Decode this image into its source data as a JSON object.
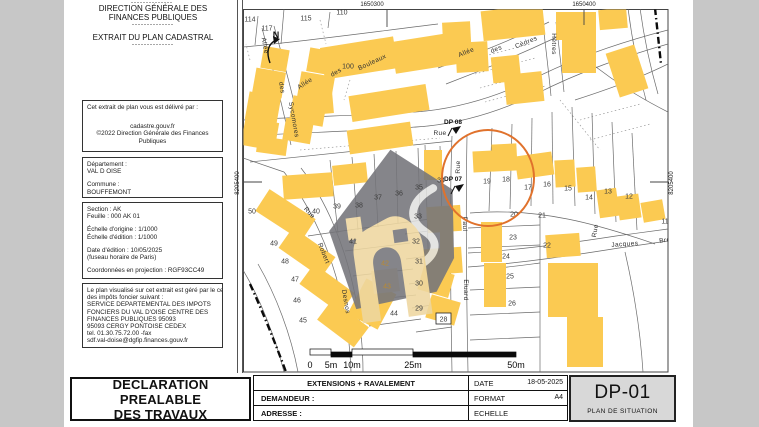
{
  "left_panel": {
    "top_dashes": "--------------",
    "header": {
      "line1": "DIRECTION GÉNÉRALE DES",
      "line2": "FINANCES PUBLIQUES",
      "dash1": "--------------",
      "subtitle": "EXTRAIT DU PLAN CADASTRAL",
      "dash2": "--------------"
    },
    "issuer_box": {
      "intro": "Cet extrait de plan vous est délivré par :",
      "site": "cadastre.gouv.fr",
      "copyright": "©2022 Direction Générale des Finances Publiques"
    },
    "location_box": {
      "lines": [
        "Département :",
        "VAL D OISE",
        "",
        "Commune :",
        "BOUFFEMONT"
      ]
    },
    "sheet_box": {
      "lines": [
        "Section : AK",
        "Feuille : 000 AK 01",
        "",
        "Échelle d'origine : 1/1000",
        "Échelle d'édition : 1/1000",
        "",
        "Date d'édition : 10/05/2025",
        "(fuseau horaire de Paris)",
        "",
        "Coordonnées en projection : RGF93CC49"
      ]
    },
    "office_box": {
      "lines": [
        "Le plan visualisé sur cet extrait est géré par le centre",
        "des impôts foncier suivant :",
        "SERVICE DEPARTEMENTAL DES IMPOTS",
        "FONCIERS DU VAL D'OISE CENTRE DES",
        "FINANCES PUBLIQUES 95093",
        "95093 CERGY PONTOISE CEDEX",
        "tel. 01.30.75.72.00 -fax",
        "sdf.val-doise@dgfip.finances.gouv.fr"
      ]
    }
  },
  "map": {
    "coords": [
      {
        "t": "1650300",
        "x": 372,
        "y": 6,
        "r": 0
      },
      {
        "t": "1650400",
        "x": 584,
        "y": 6,
        "r": 0
      },
      {
        "t": "8205400",
        "x": 239,
        "y": 183,
        "r": -90
      },
      {
        "t": "8205400",
        "x": 673,
        "y": 183,
        "r": -90
      }
    ],
    "north_label": "N",
    "parcels": [
      {
        "n": "114",
        "x": 250,
        "y": 19
      },
      {
        "n": "117",
        "x": 267,
        "y": 28
      },
      {
        "n": "115",
        "x": 306,
        "y": 18
      },
      {
        "n": "110",
        "x": 342,
        "y": 12
      },
      {
        "n": "100",
        "x": 348,
        "y": 66
      },
      {
        "n": "50",
        "x": 252,
        "y": 211
      },
      {
        "n": "49",
        "x": 274,
        "y": 243
      },
      {
        "n": "48",
        "x": 285,
        "y": 261
      },
      {
        "n": "47",
        "x": 295,
        "y": 279
      },
      {
        "n": "46",
        "x": 297,
        "y": 300
      },
      {
        "n": "45",
        "x": 303,
        "y": 320
      },
      {
        "n": "40",
        "x": 316,
        "y": 211
      },
      {
        "n": "39",
        "x": 337,
        "y": 206
      },
      {
        "n": "38",
        "x": 359,
        "y": 205
      },
      {
        "n": "37",
        "x": 378,
        "y": 197
      },
      {
        "n": "36",
        "x": 399,
        "y": 193
      },
      {
        "n": "35",
        "x": 419,
        "y": 187
      },
      {
        "n": "34",
        "x": 441,
        "y": 180
      },
      {
        "n": "41",
        "x": 353,
        "y": 241
      },
      {
        "n": "42",
        "x": 385,
        "y": 263,
        "hl": true
      },
      {
        "n": "43",
        "x": 387,
        "y": 286,
        "hl": true
      },
      {
        "n": "44",
        "x": 394,
        "y": 313
      },
      {
        "n": "33",
        "x": 418,
        "y": 216
      },
      {
        "n": "32",
        "x": 416,
        "y": 241
      },
      {
        "n": "31",
        "x": 419,
        "y": 261
      },
      {
        "n": "30",
        "x": 419,
        "y": 283
      },
      {
        "n": "29",
        "x": 419,
        "y": 308
      },
      {
        "n": "19",
        "x": 487,
        "y": 181
      },
      {
        "n": "18",
        "x": 506,
        "y": 179
      },
      {
        "n": "17",
        "x": 528,
        "y": 187
      },
      {
        "n": "16",
        "x": 547,
        "y": 184
      },
      {
        "n": "15",
        "x": 568,
        "y": 188
      },
      {
        "n": "14",
        "x": 589,
        "y": 197
      },
      {
        "n": "13",
        "x": 608,
        "y": 191
      },
      {
        "n": "12",
        "x": 629,
        "y": 196
      },
      {
        "n": "11",
        "x": 665,
        "y": 221
      },
      {
        "n": "20",
        "x": 514,
        "y": 214
      },
      {
        "n": "21",
        "x": 542,
        "y": 215
      },
      {
        "n": "22",
        "x": 547,
        "y": 245
      },
      {
        "n": "23",
        "x": 513,
        "y": 237
      },
      {
        "n": "24",
        "x": 506,
        "y": 256
      },
      {
        "n": "25",
        "x": 510,
        "y": 276
      },
      {
        "n": "26",
        "x": 512,
        "y": 303
      }
    ],
    "boxed_parcel": {
      "n": "28",
      "x": 436,
      "y": 313,
      "w": 15,
      "h": 11
    },
    "streets": [
      {
        "t": "Allée",
        "x": 263,
        "y": 46,
        "r": 80
      },
      {
        "t": "des",
        "x": 280,
        "y": 88,
        "r": 80
      },
      {
        "t": "Sycomores",
        "x": 292,
        "y": 120,
        "r": 80
      },
      {
        "t": "Allée",
        "x": 306,
        "y": 85,
        "r": -33
      },
      {
        "t": "des",
        "x": 337,
        "y": 74,
        "r": -30
      },
      {
        "t": "Bouleaux",
        "x": 373,
        "y": 64,
        "r": -25
      },
      {
        "t": "Allée",
        "x": 467,
        "y": 54,
        "r": -22
      },
      {
        "t": "des",
        "x": 497,
        "y": 51,
        "r": -22
      },
      {
        "t": "Cèdres",
        "x": 527,
        "y": 44,
        "r": -22
      },
      {
        "t": "Hêtres",
        "x": 552,
        "y": 44,
        "r": 90
      },
      {
        "t": "Rue",
        "x": 440,
        "y": 135,
        "r": 0
      },
      {
        "t": "Rue",
        "x": 460,
        "y": 167,
        "r": -90
      },
      {
        "t": "Paul",
        "x": 463,
        "y": 224,
        "r": 90
      },
      {
        "t": "Eluard",
        "x": 464,
        "y": 290,
        "r": 90
      },
      {
        "t": "Rue",
        "x": 308,
        "y": 214,
        "r": 48
      },
      {
        "t": "Robert",
        "x": 322,
        "y": 254,
        "r": 68
      },
      {
        "t": "Desnos",
        "x": 344,
        "y": 302,
        "r": 80
      },
      {
        "t": "Rue",
        "x": 597,
        "y": 231,
        "r": -80
      },
      {
        "t": "Jacques",
        "x": 625,
        "y": 246,
        "r": -4
      },
      {
        "t": "Brel",
        "x": 666,
        "y": 242,
        "r": -8
      }
    ],
    "dp_markers": [
      {
        "t": "DP 08",
        "x": 444,
        "y": 124,
        "ix": 452,
        "iy": 128
      },
      {
        "t": "DP 07",
        "x": 444,
        "y": 181,
        "ix": 455,
        "iy": 186
      }
    ],
    "scale_bar": {
      "labels": [
        [
          "0",
          310
        ],
        [
          "5m",
          331
        ],
        [
          "10m",
          352
        ],
        [
          "25m",
          413
        ],
        [
          "50m",
          516
        ]
      ],
      "segments": [
        [
          310,
          349,
          21,
          6,
          "w"
        ],
        [
          331,
          352,
          21,
          5,
          "b"
        ],
        [
          352,
          349,
          61,
          6,
          "w"
        ],
        [
          413,
          352,
          103,
          5,
          "b"
        ]
      ]
    },
    "circle": {
      "cx": 488,
      "cy": 178,
      "r": 46
    },
    "colors": {
      "building": "#fbca52",
      "parcel_highlight": "#f3dfad",
      "highlight_text": "#b98a33",
      "circle": "#e0722c",
      "watermark_gray": "#75757a",
      "watermark_tan": "#eed7a0",
      "line": "#6b6b6b"
    }
  },
  "title_block": {
    "project_title_line1": "DECLARATION PREALABLE",
    "project_title_line2": "DES TRAVAUX",
    "works": "EXTENSIONS + RAVALEMENT",
    "demandeur_label": "DEMANDEUR :",
    "adresse_label": "ADRESSE :",
    "date_label": "DATE",
    "date_value": "18-05-2025",
    "format_label": "FORMAT",
    "format_value": "A4",
    "echelle_label": "ECHELLE",
    "echelle_value": "",
    "sheet_code": "DP-01",
    "sheet_name": "PLAN DE SITUATION"
  }
}
